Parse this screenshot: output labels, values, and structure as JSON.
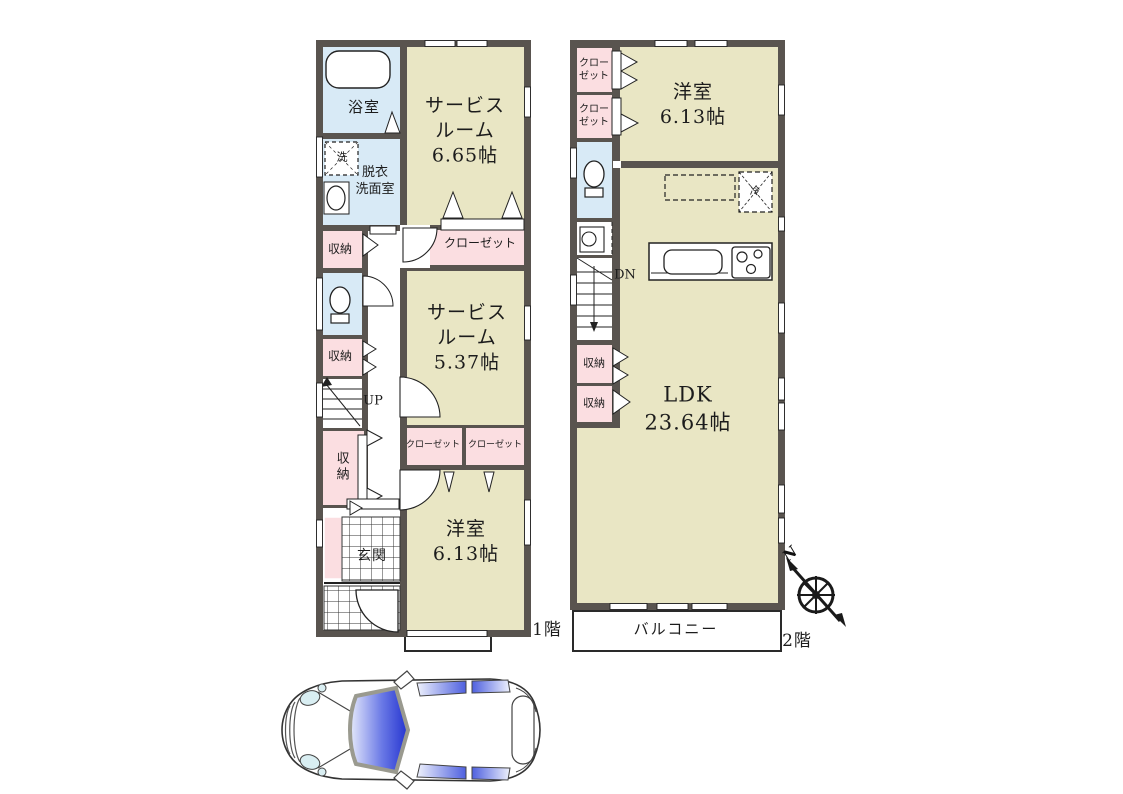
{
  "floor1": {
    "floor_label": "1階",
    "bath": "浴室",
    "washer": "洗",
    "powder_line1": "脱衣",
    "powder_line2": "洗面室",
    "storage1": "収納",
    "storage2": "収納",
    "storage3": "収納",
    "stairs_up": "UP",
    "entrance": "玄関",
    "service_room1": {
      "line1": "サービス",
      "line2": "ルーム",
      "area": "6.65帖"
    },
    "closet_main": "クローゼット",
    "service_room2": {
      "line1": "サービス",
      "line2": "ルーム",
      "area": "5.37帖"
    },
    "closet_left": "クローゼット",
    "closet_right": "クローゼット",
    "western_room": {
      "name": "洋室",
      "area": "6.13帖"
    }
  },
  "floor2": {
    "floor_label": "2階",
    "closet_a_line1": "クロー",
    "closet_a_line2": "ゼット",
    "closet_b_line1": "クロー",
    "closet_b_line2": "ゼット",
    "stairs_down": "DN",
    "storage_a": "収納",
    "storage_b": "収納",
    "western_room": {
      "name": "洋室",
      "area": "6.13帖"
    },
    "fridge": "冷",
    "ldk": {
      "name": "LDK",
      "area": "23.64帖"
    },
    "balcony": "バルコニー"
  },
  "compass": {
    "north": "N"
  },
  "colors": {
    "wall": "#59544f",
    "room": "#e9e6c4",
    "closet": "#fbdee1",
    "wet": "#d8eaf6"
  }
}
